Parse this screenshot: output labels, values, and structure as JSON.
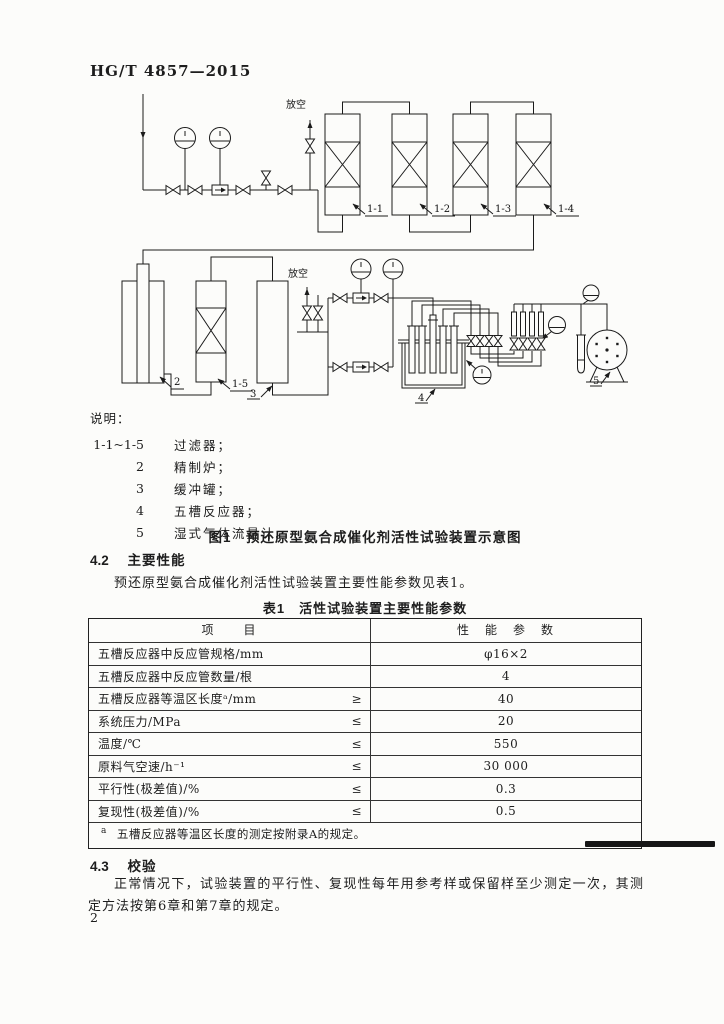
{
  "header": {
    "standard_code": "HG/T 4857—2015"
  },
  "diagram": {
    "vent_top_label": "放空",
    "vent_mid_label": "放空",
    "labels": {
      "filter_1_1": "1-1",
      "filter_1_2": "1-2",
      "filter_1_3": "1-3",
      "filter_1_4": "1-4",
      "filter_1_5": "1-5",
      "furnace": "2",
      "buffer_tank": "3",
      "reactor": "4",
      "wet_flowmeter": "5"
    }
  },
  "legend": {
    "title": "说明：",
    "items": [
      {
        "key": "1-1~1-5",
        "label": "过滤器；"
      },
      {
        "key": "2",
        "label": "精制炉；"
      },
      {
        "key": "3",
        "label": "缓冲罐；"
      },
      {
        "key": "4",
        "label": "五槽反应器；"
      },
      {
        "key": "5",
        "label": "湿式气体流量计。"
      }
    ]
  },
  "figure_caption": "图1　预还原型氨合成催化剂活性试验装置示意图",
  "sections": {
    "s42": {
      "number": "4.2",
      "title": "主要性能",
      "body": "预还原型氨合成催化剂活性试验装置主要性能参数见表1。"
    },
    "s43": {
      "number": "4.3",
      "title": "校验",
      "body": "正常情况下，试验装置的平行性、复现性每年用参考样或保留样至少测定一次，其测定方法按第6章和第7章的规定。"
    }
  },
  "table": {
    "caption": "表1　活性试验装置主要性能参数",
    "columns": [
      "项　　目",
      "性　能　参　数"
    ],
    "rows": [
      {
        "item": "五槽反应器中反应管规格/mm",
        "relation": "",
        "value": "φ16×2"
      },
      {
        "item": "五槽反应器中反应管数量/根",
        "relation": "",
        "value": "4"
      },
      {
        "item": "五槽反应器等温区长度ᵃ/mm",
        "relation": "≥",
        "value": "40"
      },
      {
        "item": "系统压力/MPa",
        "relation": "≤",
        "value": "20"
      },
      {
        "item": "温度/℃",
        "relation": "≤",
        "value": "550"
      },
      {
        "item": "原料气空速/h⁻¹",
        "relation": "≤",
        "value": "30 000"
      },
      {
        "item": "平行性(极差值)/%",
        "relation": "≤",
        "value": "0.3"
      },
      {
        "item": "复现性(极差值)/%",
        "relation": "≤",
        "value": "0.5"
      }
    ],
    "footnote_marker": "a",
    "footnote_text": "五槽反应器等温区长度的测定按附录A的规定。"
  },
  "page_number": "2"
}
